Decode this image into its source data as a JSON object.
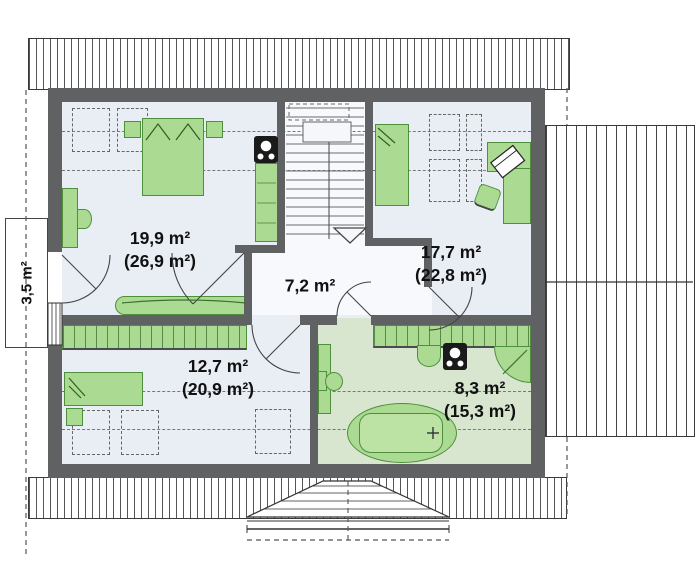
{
  "plan_type": "floor-plan",
  "rooms": [
    {
      "key": "bedroom-1",
      "area": "19,9 m²",
      "total_area": "(26,9 m²)"
    },
    {
      "key": "bedroom-2",
      "area": "17,7 m²",
      "total_area": "(22,8 m²)"
    },
    {
      "key": "hall",
      "area": "7,2 m²",
      "total_area": ""
    },
    {
      "key": "bedroom-3",
      "area": "12,7 m²",
      "total_area": "(20,9 m²)"
    },
    {
      "key": "bathroom",
      "area": "8,3 m²",
      "total_area": "(15,3 m²)"
    },
    {
      "key": "balcony",
      "area": "3,5 m²",
      "total_area": ""
    }
  ],
  "colors": {
    "wall": "#5f6163",
    "floor": "#e9edf4",
    "hall_floor": "#f7f9fc",
    "bathroom_floor": "#d8e5cf",
    "furniture": "#abdb92",
    "furniture_border": "#4e8f3c",
    "furniture_light": "#bce2a4",
    "roof_line": "#3a3a3a",
    "text": "#111111",
    "dash": "#666666"
  }
}
